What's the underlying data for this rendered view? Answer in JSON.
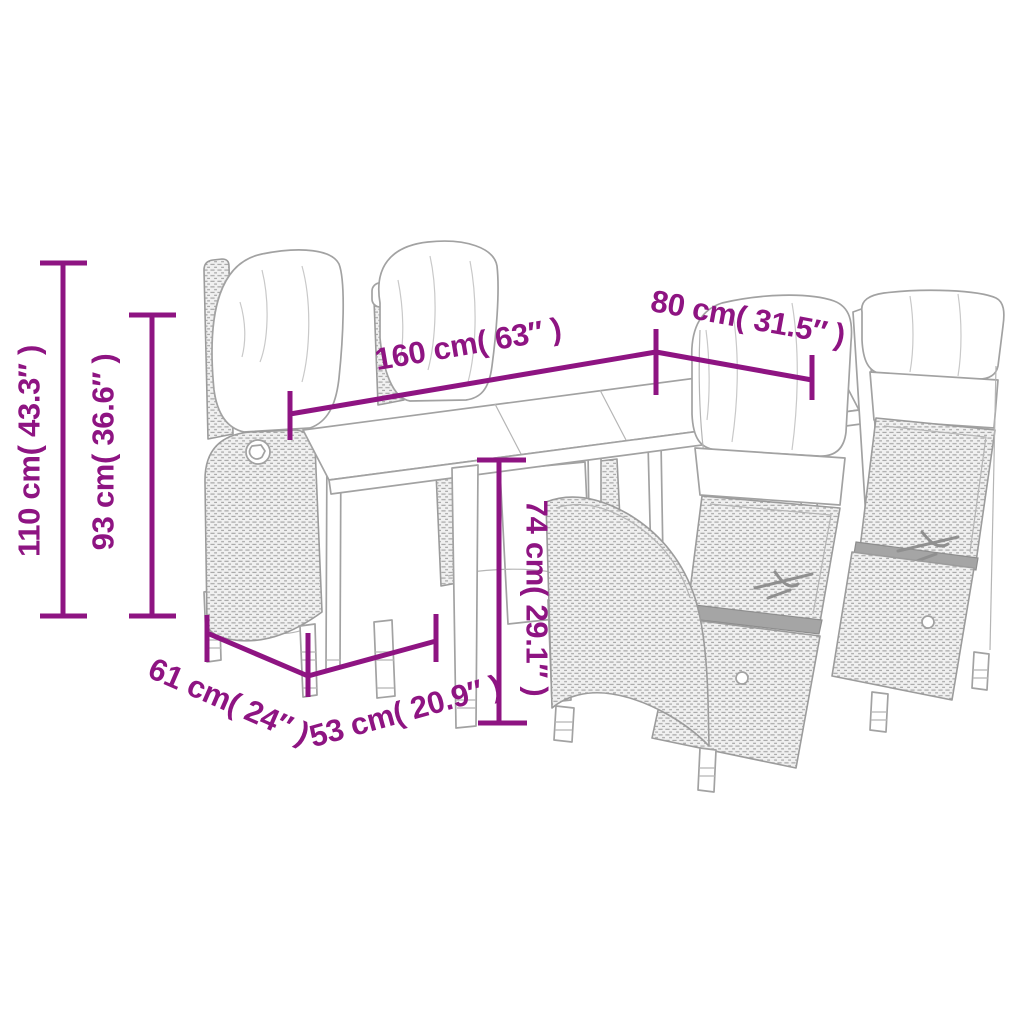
{
  "diagram": {
    "type": "product-dimension-diagram",
    "subject": "poly rattan garden dining set: long table with two reclining wicker chairs behind and two in front, all with cushions",
    "colors": {
      "dimension_accent": "#8e1482",
      "line_art_gray": "#a2a2a2",
      "background": "#ffffff"
    },
    "labels": {
      "dim_110": "110 cm( 43.3″ )",
      "dim_93": "93 cm( 36.6″ )",
      "dim_160": "160 cm( 63″ )",
      "dim_80": "80 cm( 31.5″ )",
      "dim_74": "74 cm( 29.1″ )",
      "dim_61": "61 cm( 24″ )",
      "dim_53": "53 cm( 20.9″ )"
    }
  }
}
